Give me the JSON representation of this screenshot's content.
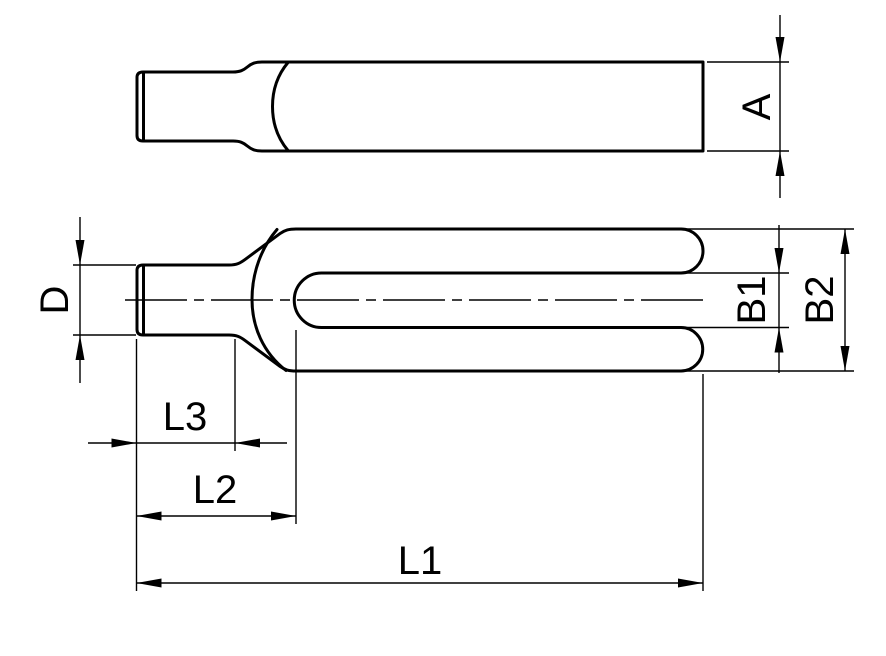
{
  "drawing": {
    "background_color": "#ffffff",
    "line_color": "#000000",
    "dimension_labels": {
      "a": "A",
      "d": "D",
      "b1": "B1",
      "b2": "B2",
      "l1": "L1",
      "l2": "L2",
      "l3": "L3"
    }
  }
}
